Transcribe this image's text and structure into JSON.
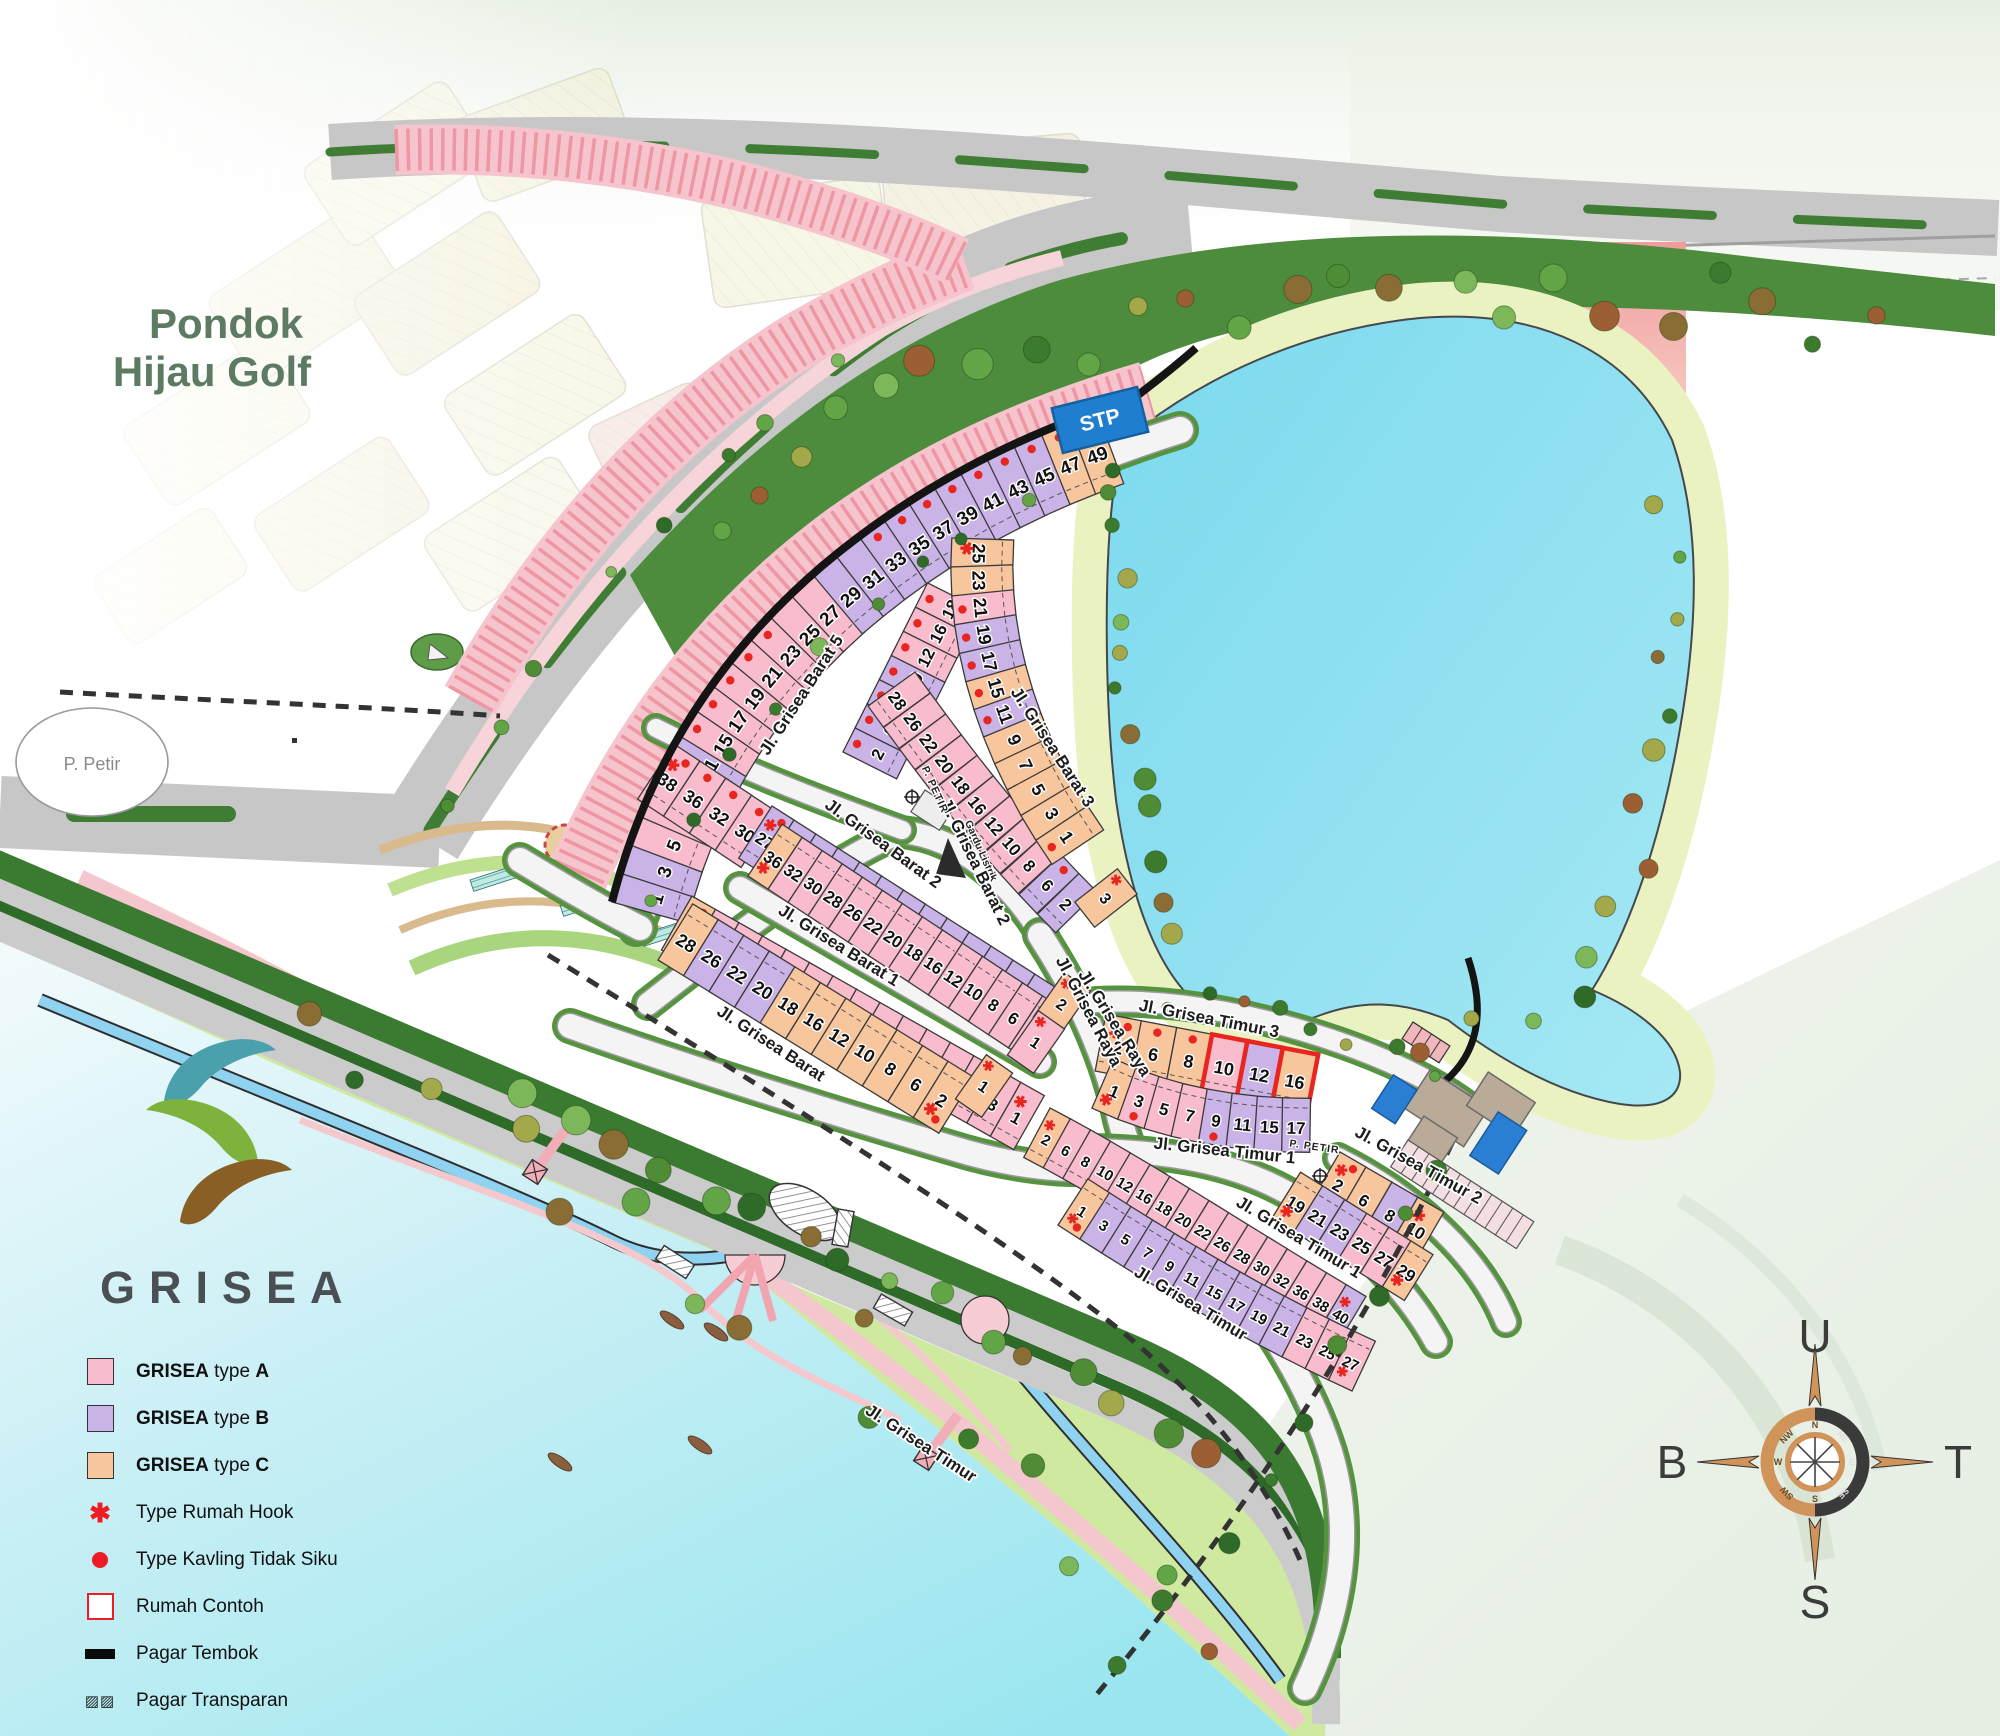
{
  "project": {
    "name": "GRISEA"
  },
  "pondok": {
    "line1": "Pondok",
    "line2": "Hijau Golf"
  },
  "facilities": {
    "stp": "STP",
    "gardu": "Gardu Listrik",
    "petir_circle": "P. Petir",
    "petir_labels": [
      {
        "text": "P. PETIR",
        "x": 932,
        "y": 791,
        "rot": 66
      },
      {
        "text": "P. PETIR",
        "x": 1314,
        "y": 1150,
        "rot": 8
      }
    ]
  },
  "legend": {
    "items": [
      {
        "kind": "A",
        "b1": "GRISEA",
        "mid": " type ",
        "letter": "A"
      },
      {
        "kind": "B",
        "b1": "GRISEA",
        "mid": " type ",
        "letter": "B"
      },
      {
        "kind": "C",
        "b1": "GRISEA",
        "mid": " type ",
        "letter": "C"
      },
      {
        "kind": "hook",
        "label": "Type Rumah Hook"
      },
      {
        "kind": "dot",
        "label": "Type Kavling Tidak Siku"
      },
      {
        "kind": "contoh",
        "label": "Rumah Contoh"
      },
      {
        "kind": "tembok",
        "label": "Pagar Tembok"
      },
      {
        "kind": "transparan",
        "label": "Pagar Transparan"
      }
    ]
  },
  "compass": {
    "north": "U",
    "east": "T",
    "south": "S",
    "west": "B",
    "minor": [
      "N",
      "NE",
      "E",
      "SE",
      "S",
      "SW",
      "W",
      "NW"
    ]
  },
  "colors": {
    "typeA": "#f8bccd",
    "typeB": "#c9b3e7",
    "typeC": "#f8c69d",
    "mark": "#e8251f",
    "lake": "#8adeef",
    "shore": "#e9f2c0",
    "stripBase": "#f5c4cd",
    "stripTick": "#ee96a3",
    "rose": "#d0935a"
  },
  "road_labels": [
    {
      "text": "Jl. Grisea Barat 5",
      "x": 806,
      "y": 698,
      "rot": -57
    },
    {
      "text": "Jl. Grisea Barat 2",
      "x": 880,
      "y": 848,
      "rot": 36
    },
    {
      "text": "Jl. Grisea Barat 2",
      "x": 970,
      "y": 864,
      "rot": 64
    },
    {
      "text": "Jl. Grisea Barat 3",
      "x": 1048,
      "y": 750,
      "rot": 57
    },
    {
      "text": "Jl. Grisea Barat 1",
      "x": 836,
      "y": 950,
      "rot": 32
    },
    {
      "text": "Jl. Grisea Barat",
      "x": 768,
      "y": 1048,
      "rot": 33
    },
    {
      "text": "Jl. Grisea Raya",
      "x": 1084,
      "y": 1014,
      "rot": 62
    },
    {
      "text": "Jl. Grisea Raya",
      "x": 1110,
      "y": 1026,
      "rot": 58
    },
    {
      "text": "Jl. Grisea Timur 3",
      "x": 1208,
      "y": 1024,
      "rot": 11
    },
    {
      "text": "Jl. Grisea Timur 1",
      "x": 1224,
      "y": 1156,
      "rot": 6
    },
    {
      "text": "Jl. Grisea Timur 1",
      "x": 1296,
      "y": 1242,
      "rot": 31
    },
    {
      "text": "Jl. Grisea Timur 2",
      "x": 1416,
      "y": 1170,
      "rot": 29
    },
    {
      "text": "Jl. Grisea Timur",
      "x": 1188,
      "y": 1308,
      "rot": 31
    },
    {
      "text": "Jl. Grisea Timur",
      "x": 918,
      "y": 1448,
      "rot": 33
    }
  ],
  "lot_rows": [
    {
      "id": "barat5",
      "path": "M 612 902 C 648 760 724 650 822 566 C 912 490 1014 436 1134 398",
      "side": 1,
      "w": 30,
      "d": 78,
      "fs": 19,
      "lots": [
        [
          1,
          "B",
          ""
        ],
        [
          3,
          "B",
          ""
        ],
        [
          5,
          "A",
          ""
        ],
        [
          7,
          "A",
          ""
        ],
        [
          9,
          "A",
          ""
        ],
        [
          11,
          "B",
          "d"
        ],
        [
          15,
          "A",
          "d"
        ],
        [
          17,
          "A",
          "d"
        ],
        [
          19,
          "A",
          "d"
        ],
        [
          21,
          "A",
          "d"
        ],
        [
          23,
          "A",
          "d"
        ],
        [
          25,
          "A",
          ""
        ],
        [
          27,
          "A",
          ""
        ],
        [
          29,
          "B",
          ""
        ],
        [
          31,
          "B",
          ""
        ],
        [
          33,
          "B",
          "d"
        ],
        [
          35,
          "B",
          "d"
        ],
        [
          37,
          "B",
          "d"
        ],
        [
          39,
          "B",
          "d"
        ],
        [
          41,
          "B",
          "d"
        ],
        [
          43,
          "B",
          "d"
        ],
        [
          45,
          "B",
          "d"
        ],
        [
          47,
          "C",
          "d"
        ],
        [
          49,
          "C",
          "h"
        ]
      ]
    },
    {
      "id": "barat5-inner",
      "path": "M 843 752 L 928 582",
      "side": 1,
      "w": 27,
      "d": 60,
      "fs": 17,
      "lots": [
        [
          2,
          "B",
          "d"
        ],
        [
          6,
          "B",
          "d"
        ],
        [
          8,
          "B",
          "d"
        ],
        [
          10,
          "B",
          "d"
        ],
        [
          12,
          "A",
          "d"
        ],
        [
          16,
          "A",
          "d"
        ],
        [
          18,
          "A",
          "d"
        ]
      ]
    },
    {
      "id": "gardu-row",
      "path": "M 674 744 L 780 814",
      "side": 1,
      "w": 31,
      "d": 66,
      "fs": 18,
      "lots": [
        [
          38,
          "A",
          "hd"
        ],
        [
          36,
          "A",
          "d"
        ],
        [
          32,
          "A",
          "d"
        ],
        [
          30,
          "A",
          "d"
        ]
      ]
    },
    {
      "id": "barat2-n",
      "path": "M 772 806 L 1066 994",
      "side": 1,
      "w": 26,
      "d": 62,
      "fs": 17,
      "lots": [
        [
          27,
          "B",
          "hd"
        ],
        [
          25,
          "B",
          ""
        ],
        [
          23,
          "B",
          ""
        ],
        [
          21,
          "B",
          ""
        ],
        [
          19,
          "B",
          ""
        ],
        [
          17,
          "B",
          ""
        ],
        [
          15,
          "B",
          ""
        ],
        [
          11,
          "B",
          ""
        ],
        [
          9,
          "B",
          ""
        ],
        [
          7,
          "B",
          ""
        ],
        [
          5,
          "B",
          ""
        ],
        [
          3,
          "B",
          ""
        ],
        [
          1,
          "B",
          ""
        ]
      ]
    },
    {
      "id": "barat2-s",
      "path": "M 748 876 L 1030 1062",
      "side": -1,
      "w": 24,
      "d": 62,
      "fs": 17,
      "lots": [
        [
          36,
          "C",
          "h"
        ],
        [
          32,
          "A",
          ""
        ],
        [
          30,
          "A",
          ""
        ],
        [
          28,
          "A",
          ""
        ],
        [
          26,
          "A",
          ""
        ],
        [
          22,
          "A",
          ""
        ],
        [
          20,
          "A",
          ""
        ],
        [
          18,
          "A",
          ""
        ],
        [
          16,
          "A",
          ""
        ],
        [
          12,
          "A",
          ""
        ],
        [
          10,
          "A",
          ""
        ],
        [
          8,
          "A",
          ""
        ],
        [
          6,
          "A",
          ""
        ],
        [
          2,
          "A",
          ""
        ]
      ]
    },
    {
      "id": "barat1-n",
      "path": "M 692 896 L 1052 1100",
      "side": 1,
      "w": 27,
      "d": 62,
      "fs": 17,
      "lots": [
        [
          31,
          "C",
          "hd"
        ],
        [
          29,
          "A",
          ""
        ],
        [
          27,
          "A",
          ""
        ],
        [
          25,
          "A",
          ""
        ],
        [
          23,
          "A",
          ""
        ],
        [
          21,
          "A",
          ""
        ],
        [
          19,
          "A",
          ""
        ],
        [
          17,
          "A",
          ""
        ],
        [
          15,
          "A",
          ""
        ],
        [
          11,
          "A",
          ""
        ],
        [
          9,
          "A",
          ""
        ],
        [
          7,
          "A",
          ""
        ],
        [
          5,
          "A",
          ""
        ],
        [
          3,
          "A",
          ""
        ],
        [
          1,
          "A",
          "h"
        ]
      ]
    },
    {
      "id": "barat1-s",
      "path": "M 658 960 L 950 1140",
      "side": -1,
      "w": 30,
      "d": 66,
      "fs": 18,
      "lots": [
        [
          28,
          "C",
          ""
        ],
        [
          26,
          "B",
          ""
        ],
        [
          22,
          "B",
          ""
        ],
        [
          20,
          "B",
          ""
        ],
        [
          18,
          "C",
          ""
        ],
        [
          16,
          "C",
          ""
        ],
        [
          12,
          "C",
          ""
        ],
        [
          10,
          "C",
          ""
        ],
        [
          8,
          "C",
          ""
        ],
        [
          6,
          "C",
          ""
        ],
        [
          2,
          "C",
          "hd"
        ]
      ]
    },
    {
      "id": "barat3-even",
      "path": "M 915 672 C 975 755 1025 820 1100 895",
      "side": 1,
      "w": 26,
      "d": 58,
      "fs": 17,
      "lots": [
        [
          28,
          "A",
          ""
        ],
        [
          26,
          "A",
          ""
        ],
        [
          22,
          "A",
          ""
        ],
        [
          20,
          "A",
          ""
        ],
        [
          18,
          "A",
          ""
        ],
        [
          16,
          "A",
          ""
        ],
        [
          12,
          "A",
          ""
        ],
        [
          10,
          "A",
          ""
        ],
        [
          8,
          "A",
          ""
        ],
        [
          6,
          "B",
          "d"
        ],
        [
          2,
          "B",
          ""
        ]
      ]
    },
    {
      "id": "barat3-odd",
      "path": "M 952 538 C 945 640 975 760 1062 878",
      "side": -1,
      "w": 29,
      "d": 62,
      "fs": 18,
      "lots": [
        [
          25,
          "C",
          "h"
        ],
        [
          23,
          "C",
          ""
        ],
        [
          21,
          "A",
          "d"
        ],
        [
          19,
          "B",
          "d"
        ],
        [
          17,
          "B",
          "d"
        ],
        [
          15,
          "C",
          "d"
        ],
        [
          11,
          "B",
          "d"
        ],
        [
          9,
          "C",
          ""
        ],
        [
          7,
          "C",
          ""
        ],
        [
          5,
          "C",
          ""
        ],
        [
          3,
          "C",
          ""
        ],
        [
          1,
          "C",
          "d"
        ]
      ]
    },
    {
      "id": "timur3-n",
      "path": "M 1106 1014 L 1336 1058",
      "side": 1,
      "w": 36,
      "d": 58,
      "fs": 18,
      "lots": [
        [
          2,
          "C",
          "hd"
        ],
        [
          6,
          "C",
          "d"
        ],
        [
          8,
          "C",
          "d"
        ],
        [
          10,
          "A",
          "c"
        ],
        [
          12,
          "B",
          "c"
        ],
        [
          16,
          "C",
          "c"
        ]
      ]
    },
    {
      "id": "timur3-s",
      "path": "M 1092 1108 C 1160 1140 1240 1154 1320 1152",
      "side": -1,
      "w": 28,
      "d": 54,
      "fs": 17,
      "lots": [
        [
          1,
          "C",
          "h"
        ],
        [
          3,
          "A",
          "d"
        ],
        [
          5,
          "A",
          ""
        ],
        [
          7,
          "A",
          ""
        ],
        [
          9,
          "B",
          "d"
        ],
        [
          11,
          "B",
          ""
        ],
        [
          15,
          "B",
          ""
        ],
        [
          17,
          "B",
          ""
        ]
      ]
    },
    {
      "id": "timur1-n",
      "path": "M 1050 1108 C 1150 1160 1260 1235 1396 1314",
      "side": 1,
      "w": 23,
      "d": 56,
      "fs": 15,
      "lots": [
        [
          2,
          "C",
          "h"
        ],
        [
          6,
          "A",
          ""
        ],
        [
          8,
          "A",
          ""
        ],
        [
          10,
          "A",
          ""
        ],
        [
          12,
          "A",
          ""
        ],
        [
          16,
          "A",
          ""
        ],
        [
          18,
          "A",
          ""
        ],
        [
          20,
          "A",
          ""
        ],
        [
          22,
          "A",
          ""
        ],
        [
          26,
          "A",
          ""
        ],
        [
          28,
          "A",
          ""
        ],
        [
          30,
          "A",
          ""
        ],
        [
          32,
          "A",
          ""
        ],
        [
          36,
          "A",
          ""
        ],
        [
          38,
          "A",
          ""
        ],
        [
          40,
          "B",
          "h"
        ]
      ]
    },
    {
      "id": "timur1-s",
      "path": "M 1058 1225 C 1150 1285 1255 1348 1372 1400",
      "side": -1,
      "w": 26,
      "d": 55,
      "fs": 15,
      "lots": [
        [
          1,
          "C",
          "hd"
        ],
        [
          3,
          "B",
          ""
        ],
        [
          5,
          "B",
          ""
        ],
        [
          7,
          "B",
          ""
        ],
        [
          9,
          "B",
          ""
        ],
        [
          11,
          "B",
          ""
        ],
        [
          15,
          "B",
          ""
        ],
        [
          17,
          "B",
          ""
        ],
        [
          19,
          "B",
          ""
        ],
        [
          21,
          "B",
          ""
        ],
        [
          23,
          "A",
          ""
        ],
        [
          25,
          "A",
          ""
        ],
        [
          27,
          "A",
          "h"
        ]
      ]
    },
    {
      "id": "timur2-n",
      "path": "M 1340 1152 L 1464 1224",
      "side": 1,
      "w": 30,
      "d": 56,
      "fs": 17,
      "lots": [
        [
          2,
          "C",
          "hd"
        ],
        [
          6,
          "C",
          ""
        ],
        [
          8,
          "B",
          ""
        ],
        [
          10,
          "C",
          "h"
        ]
      ]
    },
    {
      "id": "timur2-s",
      "path": "M 1272 1218 L 1410 1304",
      "side": -1,
      "w": 26,
      "d": 54,
      "fs": 17,
      "lots": [
        [
          19,
          "C",
          "h"
        ],
        [
          21,
          "B",
          ""
        ],
        [
          23,
          "B",
          ""
        ],
        [
          25,
          "A",
          ""
        ],
        [
          27,
          "A",
          ""
        ],
        [
          29,
          "C",
          "h"
        ]
      ]
    }
  ],
  "corner_lots": [
    {
      "n": 1,
      "t": "C",
      "x": 984,
      "y": 1086,
      "rot": 35,
      "m": "h"
    },
    {
      "n": 2,
      "t": "C",
      "x": 1062,
      "y": 1004,
      "rot": 35,
      "m": "h"
    },
    {
      "n": 1,
      "t": "A",
      "x": 1036,
      "y": 1042,
      "rot": 35,
      "m": "h"
    },
    {
      "n": 3,
      "t": "C",
      "x": 1106,
      "y": 898,
      "rot": 52,
      "m": "h"
    }
  ]
}
